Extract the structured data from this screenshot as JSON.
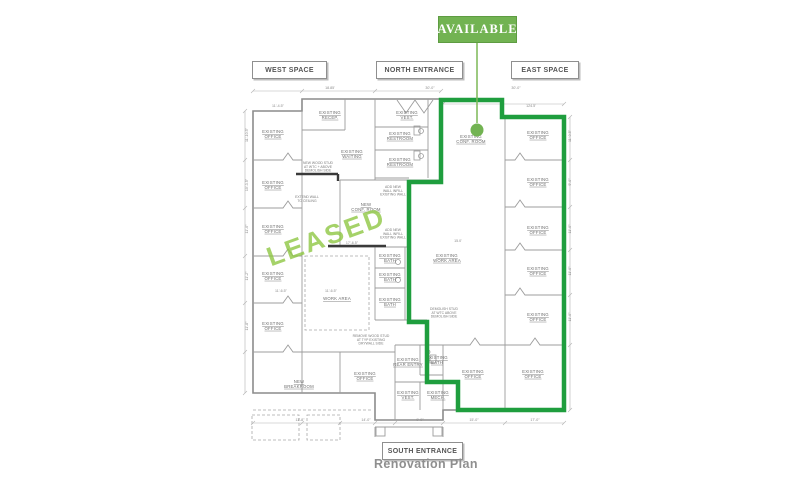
{
  "page": {
    "caption": "Renovation Plan"
  },
  "availability": {
    "available_label": "AVAILABLE",
    "leased_watermark": "LEASED",
    "available_fill": "#72b352",
    "outline_color": "#1f9e3e",
    "watermark_color": "#8cc63f",
    "leader_color": "#7cb857"
  },
  "entrance_labels": {
    "west": "WEST SPACE",
    "north": "NORTH ENTRANCE",
    "east": "EAST SPACE",
    "south": "SOUTH ENTRANCE"
  },
  "plan": {
    "room_labels": [
      {
        "lines": [
          "EXISTING",
          "OFFICE"
        ],
        "x": 273,
        "y": 133
      },
      {
        "lines": [
          "EXISTING",
          "OFFICE"
        ],
        "x": 273,
        "y": 184
      },
      {
        "lines": [
          "EXISTING",
          "OFFICE"
        ],
        "x": 273,
        "y": 228
      },
      {
        "lines": [
          "EXISTING",
          "OFFICE"
        ],
        "x": 273,
        "y": 275
      },
      {
        "lines": [
          "EXISTING",
          "OFFICE"
        ],
        "x": 273,
        "y": 325
      },
      {
        "lines": [
          "EXISTING",
          "RECEP."
        ],
        "x": 330,
        "y": 114
      },
      {
        "lines": [
          "EXISTING",
          "VEST."
        ],
        "x": 407,
        "y": 114
      },
      {
        "lines": [
          "EXISTING",
          "RESTROOM"
        ],
        "x": 400,
        "y": 135
      },
      {
        "lines": [
          "EXISTING",
          "RESTROOM"
        ],
        "x": 400,
        "y": 161
      },
      {
        "lines": [
          "EXISTING",
          "WAITING"
        ],
        "x": 352,
        "y": 153
      },
      {
        "lines": [
          "EXISTING",
          "CONF. ROOM"
        ],
        "x": 471,
        "y": 138
      },
      {
        "lines": [
          "NEW",
          "CONF. ROOM"
        ],
        "x": 366,
        "y": 206
      },
      {
        "lines": [
          "EXISTING",
          "OFFICE"
        ],
        "x": 538,
        "y": 134
      },
      {
        "lines": [
          "EXISTING",
          "OFFICE"
        ],
        "x": 538,
        "y": 181
      },
      {
        "lines": [
          "EXISTING",
          "OFFICE"
        ],
        "x": 538,
        "y": 229
      },
      {
        "lines": [
          "EXISTING",
          "OFFICE"
        ],
        "x": 538,
        "y": 270
      },
      {
        "lines": [
          "EXISTING",
          "OFFICE"
        ],
        "x": 538,
        "y": 316
      },
      {
        "lines": [
          "EXISTING",
          "WORK AREA"
        ],
        "x": 447,
        "y": 257
      },
      {
        "lines": [
          "WORK AREA"
        ],
        "x": 337,
        "y": 300
      },
      {
        "lines": [
          "EXISTING",
          "BATH"
        ],
        "x": 390,
        "y": 257
      },
      {
        "lines": [
          "EXISTING",
          "BATH"
        ],
        "x": 390,
        "y": 276
      },
      {
        "lines": [
          "EXISTING",
          "BATH"
        ],
        "x": 390,
        "y": 301
      },
      {
        "lines": [
          "NEW",
          "BREAKROOM"
        ],
        "x": 299,
        "y": 383
      },
      {
        "lines": [
          "EXISTING",
          "OFFICE"
        ],
        "x": 365,
        "y": 375
      },
      {
        "lines": [
          "EXISTING",
          "REAR ENTRY"
        ],
        "x": 408,
        "y": 361
      },
      {
        "lines": [
          "EXISTING",
          "BATH"
        ],
        "x": 437,
        "y": 359
      },
      {
        "lines": [
          "EXISTING",
          "VEST."
        ],
        "x": 408,
        "y": 394
      },
      {
        "lines": [
          "EXISTING",
          "MECH."
        ],
        "x": 438,
        "y": 394
      },
      {
        "lines": [
          "EXISTING",
          "OFFICE"
        ],
        "x": 473,
        "y": 373
      },
      {
        "lines": [
          "EXISTING",
          "OFFICE"
        ],
        "x": 533,
        "y": 373
      }
    ],
    "notes": [
      {
        "lines": [
          "NEW WOOD STUD",
          "AT WTC + ABOVE",
          "DEMOLISH SIDE"
        ],
        "x": 318,
        "y": 164
      },
      {
        "lines": [
          "ADD NEW",
          "WALL INFILL",
          "EXISTING WALL"
        ],
        "x": 393,
        "y": 188
      },
      {
        "lines": [
          "ADD NEW",
          "WALL INFILL",
          "EXISTING WALL"
        ],
        "x": 393,
        "y": 231
      },
      {
        "lines": [
          "EXTEND WALL",
          "TO CEILING"
        ],
        "x": 307,
        "y": 198
      },
      {
        "lines": [
          "REMOVE WOOD STUD",
          "AT TYP EXISTING",
          "DRYWALL SIDE"
        ],
        "x": 371,
        "y": 337
      },
      {
        "lines": [
          "DEMOLISH STUD",
          "AT WTC ABOVE",
          "DEMOLISH SIDE"
        ],
        "x": 444,
        "y": 310
      }
    ],
    "dimensions": [
      {
        "text": "18.85'",
        "x": 330,
        "y": 89
      },
      {
        "text": "30'-0\"",
        "x": 430,
        "y": 89
      },
      {
        "text": "30'-0\"",
        "x": 516,
        "y": 89
      },
      {
        "text": "11'-4.5\"",
        "x": 278,
        "y": 107
      },
      {
        "text": "124.5'",
        "x": 531,
        "y": 107
      },
      {
        "text": "11'-10.5\"",
        "x": 248,
        "y": 135,
        "rot": -90
      },
      {
        "text": "10'-3.5\"",
        "x": 248,
        "y": 185,
        "rot": -90
      },
      {
        "text": "11'-0\"",
        "x": 248,
        "y": 229,
        "rot": -90
      },
      {
        "text": "11'-2\"",
        "x": 248,
        "y": 276,
        "rot": -90
      },
      {
        "text": "11'-8\"",
        "x": 248,
        "y": 326,
        "rot": -90
      },
      {
        "text": "11'-0.5\"",
        "x": 571,
        "y": 136,
        "rot": -90
      },
      {
        "text": "9'-0\"",
        "x": 571,
        "y": 182,
        "rot": -90
      },
      {
        "text": "11'-0\"",
        "x": 571,
        "y": 229,
        "rot": -90
      },
      {
        "text": "11'-0\"",
        "x": 571,
        "y": 271,
        "rot": -90
      },
      {
        "text": "11'-0\"",
        "x": 571,
        "y": 317,
        "rot": -90
      },
      {
        "text": "11'-6.5\"",
        "x": 281,
        "y": 292
      },
      {
        "text": "11'-6.5\"",
        "x": 331,
        "y": 292
      },
      {
        "text": "17'-6.5\"",
        "x": 352,
        "y": 244
      },
      {
        "text": "15.0'",
        "x": 458,
        "y": 242
      },
      {
        "text": "11'-8\"",
        "x": 300,
        "y": 421
      },
      {
        "text": "14'-0\"",
        "x": 366,
        "y": 421
      },
      {
        "text": "9'-0\"",
        "x": 420,
        "y": 421
      },
      {
        "text": "15'-0\"",
        "x": 474,
        "y": 421
      },
      {
        "text": "17'-0\"",
        "x": 535,
        "y": 421
      }
    ]
  }
}
